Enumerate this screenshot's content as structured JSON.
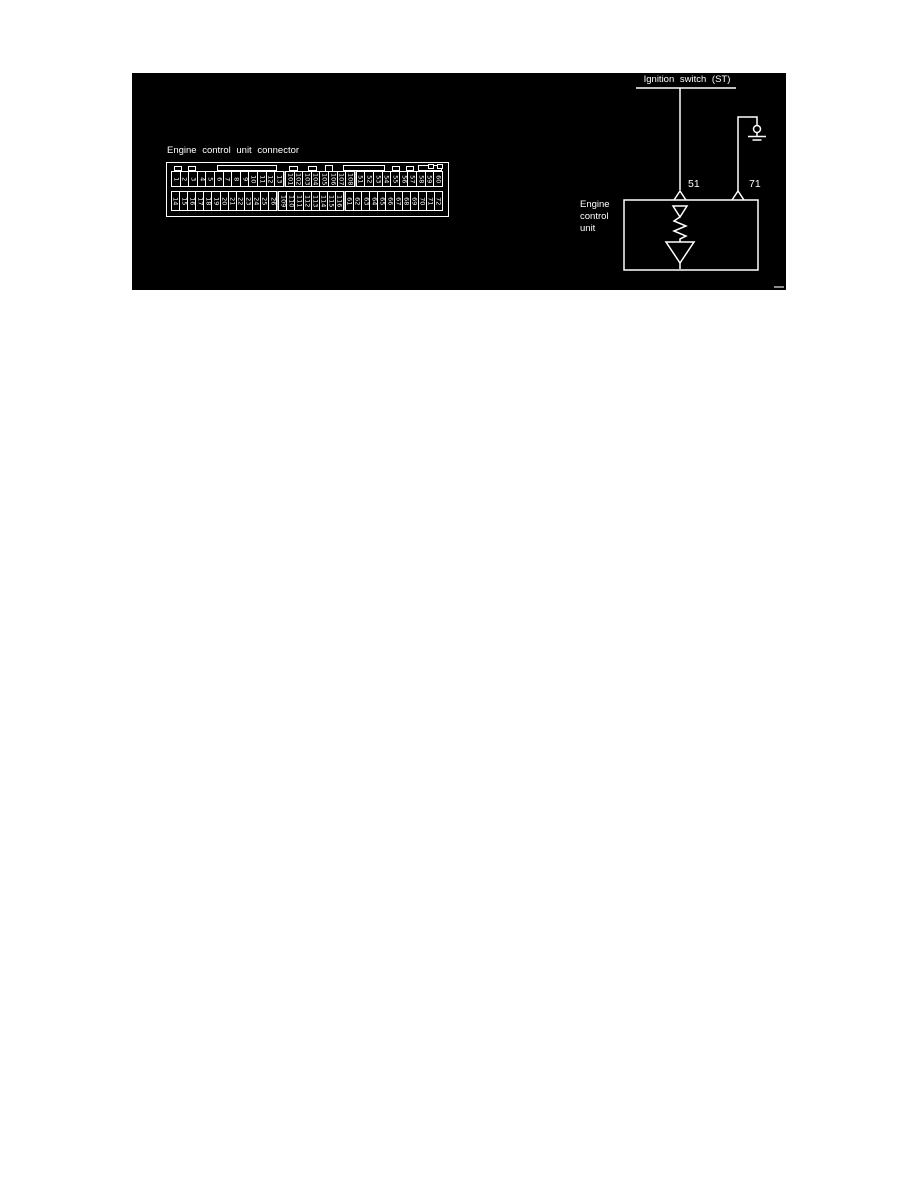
{
  "page": {
    "background": "#ffffff"
  },
  "panel": {
    "background": "#000000",
    "line_color": "#ffffff",
    "divider_color": "#9a9a9a"
  },
  "connector": {
    "label": "Engine control unit connector",
    "rows": [
      {
        "name": "top",
        "groups": [
          [
            "1",
            "2",
            "3",
            "4",
            "5",
            "6",
            "7",
            "8",
            "9",
            "10",
            "11",
            "12",
            "13"
          ],
          [
            "101",
            "102",
            "103",
            "104",
            "105",
            "106",
            "107",
            "108"
          ],
          [
            "51",
            "52",
            "53",
            "54",
            "55",
            "56",
            "57",
            "58",
            "59",
            "60"
          ]
        ]
      },
      {
        "name": "bottom",
        "groups": [
          [
            "14",
            "15",
            "16",
            "17",
            "18",
            "19",
            "20",
            "21",
            "22",
            "23",
            "24",
            "25",
            "26"
          ],
          [
            "109",
            "110",
            "111",
            "112",
            "113",
            "114",
            "115",
            "116"
          ],
          [
            "61",
            "62",
            "63",
            "64",
            "65",
            "66",
            "67",
            "68",
            "69",
            "70",
            "71",
            "72"
          ]
        ]
      }
    ]
  },
  "circuit": {
    "ignition_label": "Ignition switch (ST)",
    "pin_51": "51",
    "pin_71": "71",
    "ecu_label_lines": [
      "Engine",
      "control",
      "unit"
    ],
    "icons": {
      "ground": "chassis-ground-icon",
      "terminal": "connector-terminal-chevron-icon",
      "resistor": "resistor-zigzag-icon",
      "diode_small": "small-diode-triangle-icon",
      "diode_large": "large-diode-triangle-icon"
    }
  }
}
